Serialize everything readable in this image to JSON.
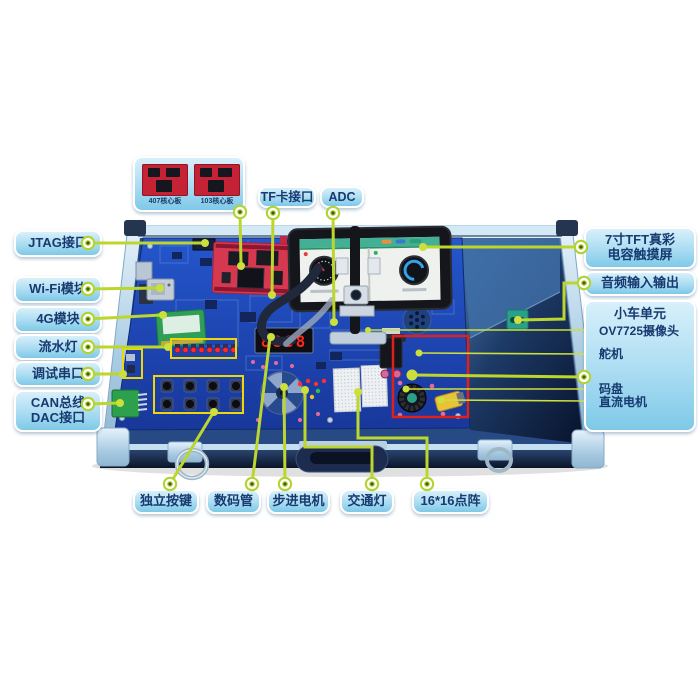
{
  "colors": {
    "callout_line": "#bdd62e",
    "bubble_fill_top": "#d8f0fa",
    "bubble_fill_bottom": "#7ec9e8",
    "bubble_text": "#173a70",
    "board_blue": "#2456cc",
    "highlight_red_box": "#e02019",
    "highlight_yellow_box": "#eed60a",
    "core_board_red": "#d63850"
  },
  "core_board_panel": {
    "items": [
      {
        "label": "407核心板"
      },
      {
        "label": "103核心板"
      }
    ]
  },
  "callouts": {
    "tf_card": "TF卡接口",
    "adc": "ADC",
    "jtag": "JTAG接口",
    "wifi": "Wi-Fi模块",
    "modem_4g": "4G模块",
    "flow_led": "流水灯",
    "debug_uart": "调试串口",
    "can_bus": "CAN总线",
    "dac": "DAC接口",
    "tft_line1": "7寸TFT真彩",
    "tft_line2": "电容触摸屏",
    "audio_io": "音频输入输出",
    "keys": "独立按键",
    "seven_seg": "数码管",
    "stepper": "步进电机",
    "traffic_light": "交通灯",
    "dot_matrix": "16*16点阵"
  },
  "car_unit": {
    "title": "小车单元",
    "camera": "OV7725摄像头",
    "servo": "舵机",
    "encoder": "码盘",
    "dc_motor": "直流电机"
  },
  "board": {
    "seg_digits": "8888"
  }
}
